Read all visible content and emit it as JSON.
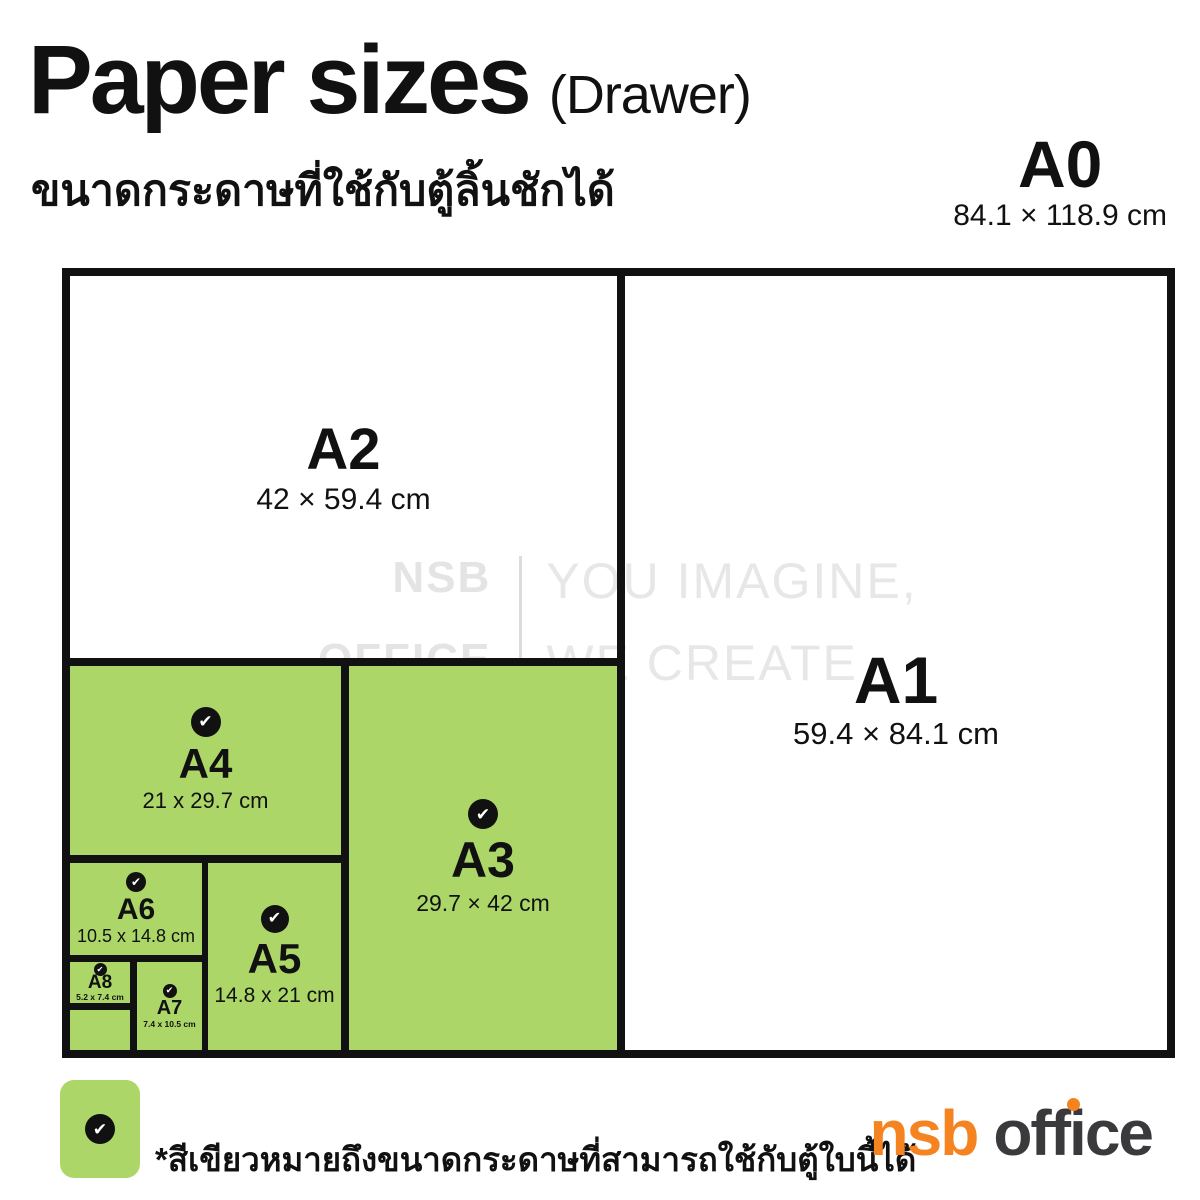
{
  "header": {
    "title": "Paper sizes",
    "title_suffix": "(Drawer)",
    "subtitle": "ขนาดกระดาษที่ใช้กับตู้ลิ้นชักได้"
  },
  "watermark": {
    "brand_top": "NSB",
    "brand_bottom": "OFFICE",
    "tagline_top": "YOU IMAGINE,",
    "tagline_bottom": "WE CREATE"
  },
  "papers": {
    "a0": {
      "name": "A0",
      "dims": "84.1 × 118.9 cm",
      "highlighted": false
    },
    "a1": {
      "name": "A1",
      "dims": "59.4 × 84.1 cm",
      "highlighted": false
    },
    "a2": {
      "name": "A2",
      "dims": "42 × 59.4 cm",
      "highlighted": false
    },
    "a3": {
      "name": "A3",
      "dims": "29.7 × 42 cm",
      "highlighted": true
    },
    "a4": {
      "name": "A4",
      "dims": "21 x 29.7 cm",
      "highlighted": true
    },
    "a5": {
      "name": "A5",
      "dims": "14.8 x 21 cm",
      "highlighted": true
    },
    "a6": {
      "name": "A6",
      "dims": "10.5 x 14.8 cm",
      "highlighted": true
    },
    "a7": {
      "name": "A7",
      "dims": "7.4 x 10.5 cm",
      "highlighted": true
    },
    "a8": {
      "name": "A8",
      "dims": "5.2 x 7.4 cm",
      "highlighted": true
    }
  },
  "legend": {
    "note": "*สีเขียวหมายถึงขนาดกระดาษที่สามารถใช้กับตู้ใบนี้ได้"
  },
  "logo": {
    "brand": "nsb",
    "suffix": "office"
  },
  "icons": {
    "check": "✔"
  },
  "colors": {
    "highlight_green": "#acd768",
    "line_black": "#111111",
    "watermark_gray": "#e4e4e4",
    "logo_orange": "#f5831f",
    "logo_dark": "#3a3a3c"
  }
}
